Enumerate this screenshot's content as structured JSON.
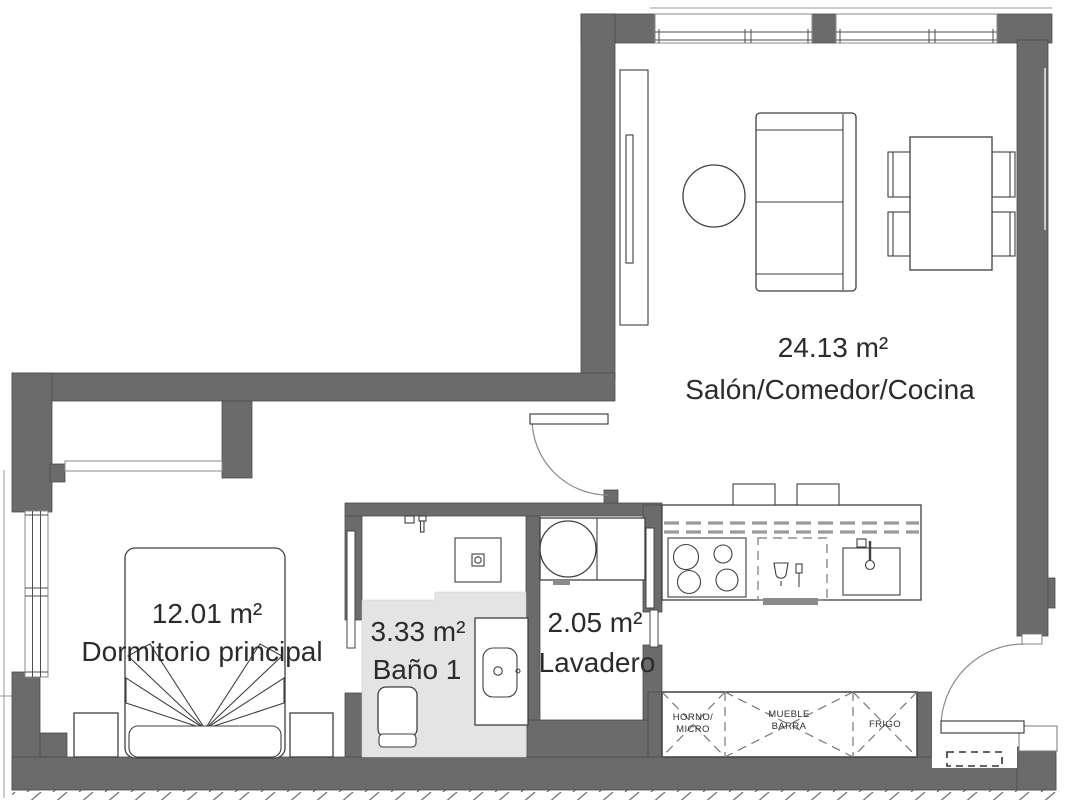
{
  "colors": {
    "wall": "#6b6b6b",
    "bath_floor": "#e4e4e4",
    "outline": "#3f3f3f",
    "text": "#2b2b2b",
    "dashed_cabinet": "#9a9a9a"
  },
  "rooms": {
    "living": {
      "area": "24.13 m²",
      "label": "Salón/Comedor/Cocina"
    },
    "bedroom": {
      "area": "12.01 m²",
      "label": "Dormitorio principal"
    },
    "bathroom": {
      "area": "3.33 m²",
      "label": "Baño 1"
    },
    "laundry": {
      "area": "2.05 m²",
      "label": "Lavadero"
    }
  },
  "cabinets": [
    {
      "line1": "HORNO/",
      "line2": "MICRO"
    },
    {
      "line1": "MUEBLE",
      "line2": "BARRA"
    },
    {
      "line1": "FRIGO",
      "line2": ""
    }
  ]
}
